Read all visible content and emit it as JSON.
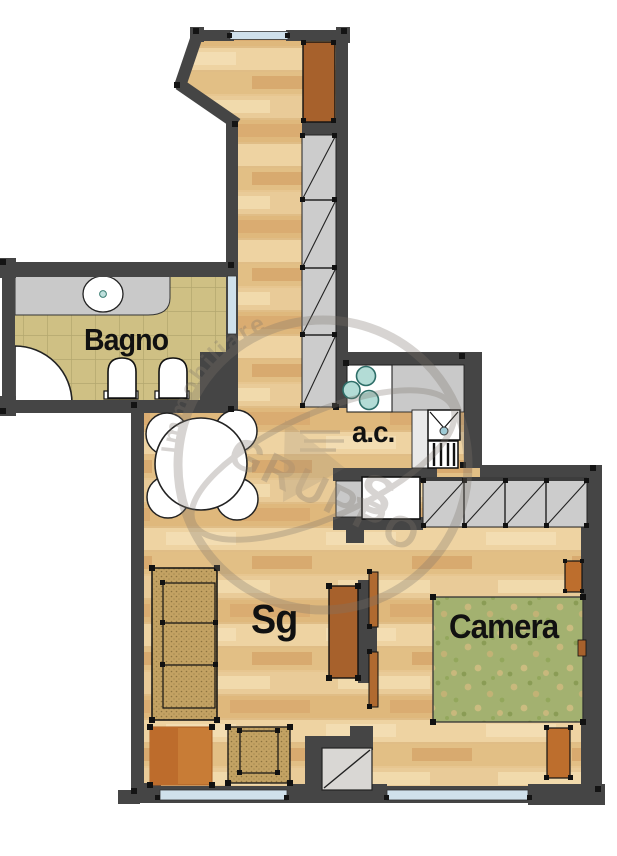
{
  "title": "Apartment floor plan",
  "rooms": {
    "bagno": {
      "label": "Bagno"
    },
    "angolo_cottura": {
      "label": "a.c."
    },
    "soggiorno": {
      "label": "Sg"
    },
    "camera": {
      "label": "Camera"
    }
  },
  "watermark": {
    "arc_text": "Immobiliare",
    "group_text": "GRUPPO",
    "letter": "S"
  },
  "colors": {
    "wall": "#454545",
    "wood_base": "#e7c690",
    "wood_light": "#f2dcae",
    "wood_dark": "#d8a96e",
    "bagno_tile": "#cfc084",
    "tile_grid": "#b3a76e",
    "closet_gray": "#cccccc",
    "window_blue": "#cfe0eb",
    "furniture_brown": "#a7612c",
    "rug_orange": "#c87c36",
    "sofa_weave": "#c3a263",
    "rug_green": "#a3b170",
    "burner_blue": "#b3dcd6",
    "label_text": "#111111"
  }
}
